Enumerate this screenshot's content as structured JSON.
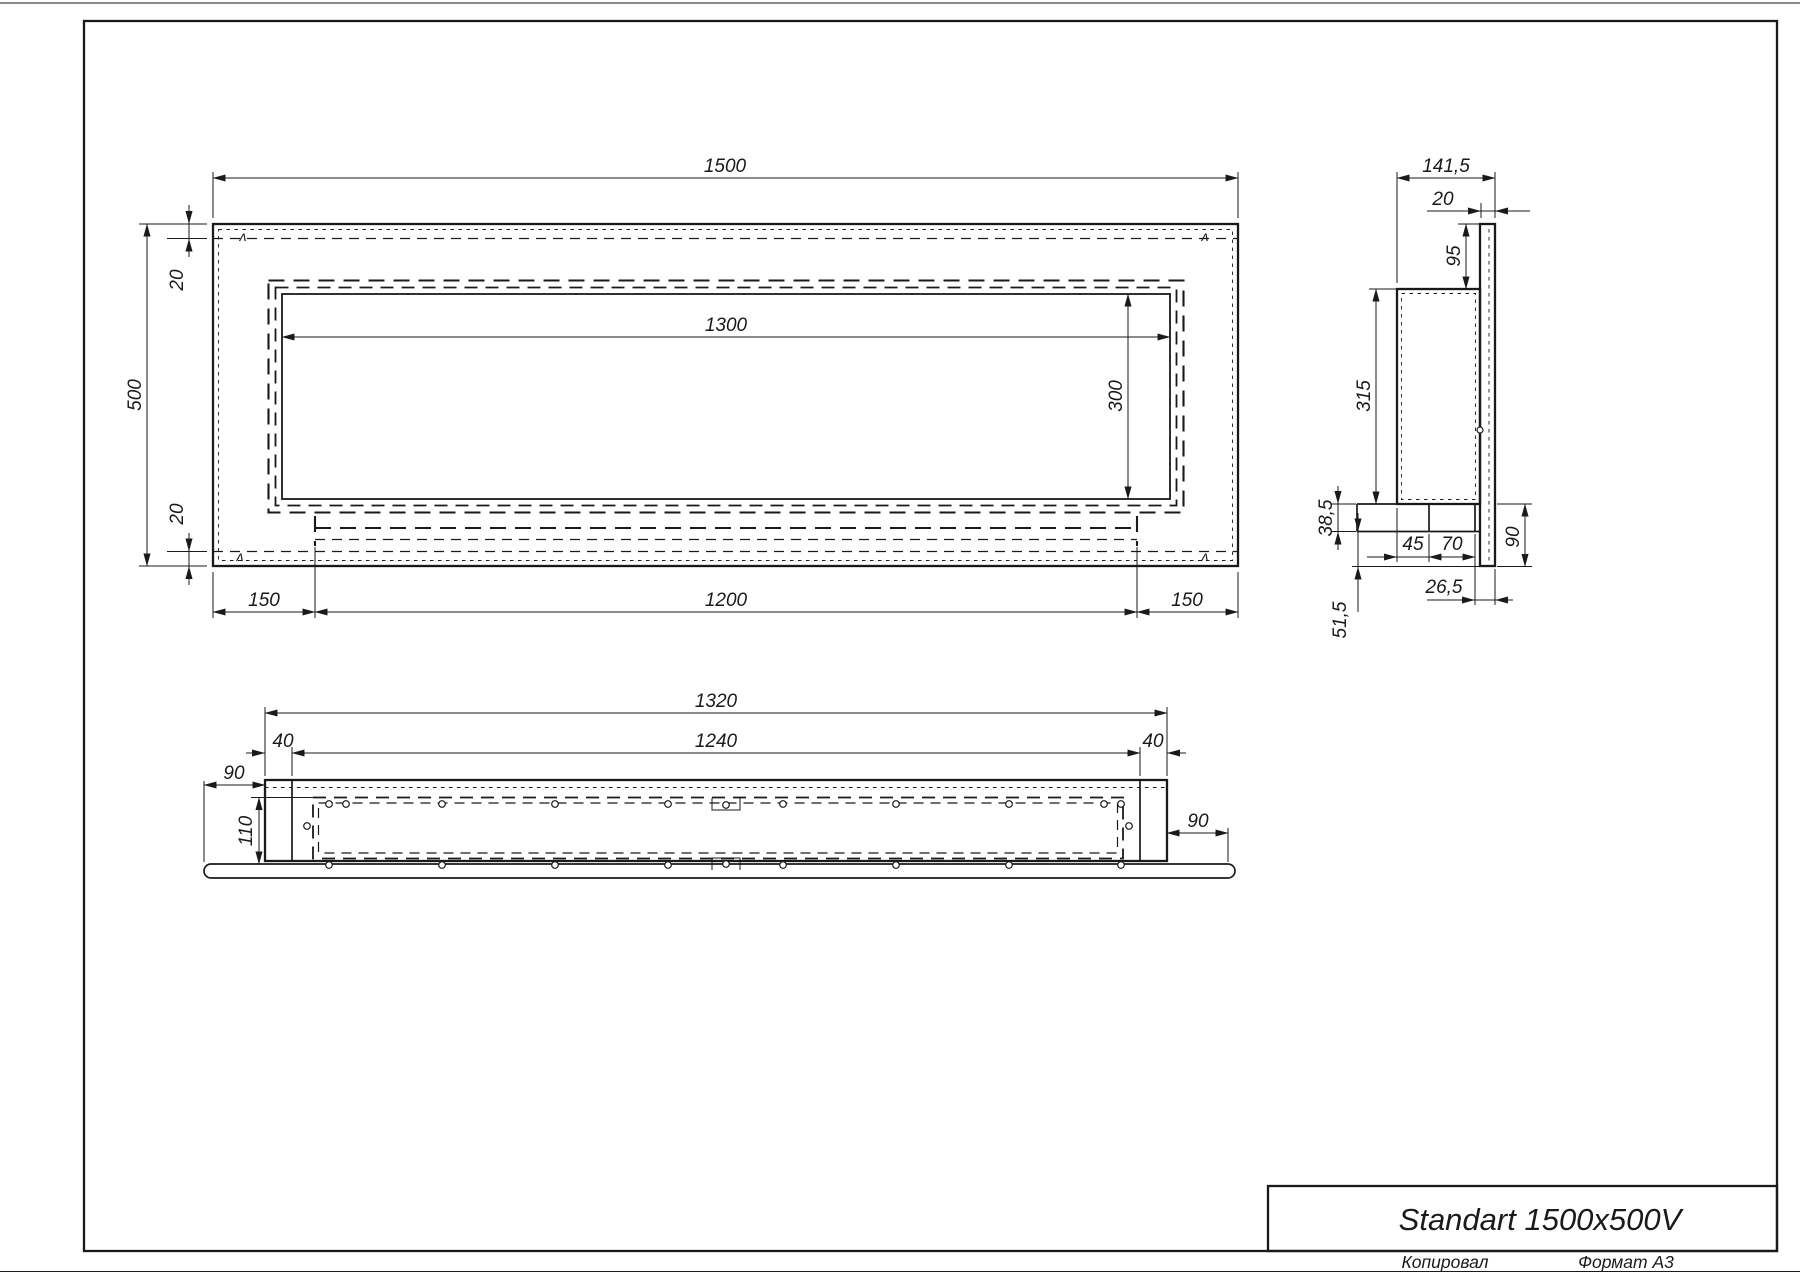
{
  "sheet": {
    "copied_label": "Копировал",
    "format_label": "Формат А3"
  },
  "title_block": {
    "title": "Standart 1500x500V"
  },
  "front_view": {
    "overall_width": "1500",
    "overall_height": "500",
    "top_offset": "20",
    "bottom_offset": "20",
    "opening_width": "1300",
    "opening_height": "300",
    "left_margin": "150",
    "tray_width": "1200",
    "right_margin": "150"
  },
  "side_view": {
    "overall_depth": "141,5",
    "flange_gap": "20",
    "top_inset": "95",
    "body_height": "315",
    "tray_height": "38,5",
    "burner_offset": "45",
    "burner_width": "70",
    "lower_height": "90",
    "flange_depth": "26,5",
    "bottom_inset": "51,5"
  },
  "bottom_view": {
    "outer_length": "1320",
    "inner_length": "1240",
    "left_wall": "40",
    "right_wall": "40",
    "left_flange": "90",
    "right_flange": "90",
    "depth": "110"
  },
  "marks": {
    "section_mark": "ʌ"
  },
  "colors": {
    "line": "#1a1a1a",
    "paper": "#ffffff"
  }
}
